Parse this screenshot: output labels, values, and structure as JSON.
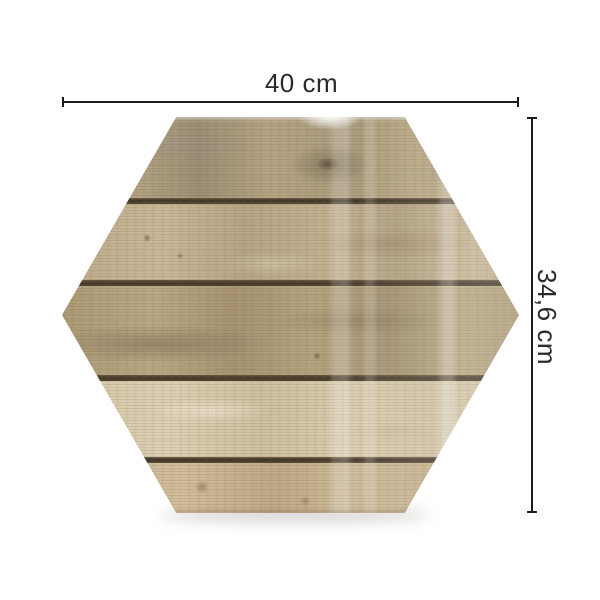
{
  "page": {
    "background": "#ffffff"
  },
  "panel": {
    "shape": "hexagon",
    "plank_count": 5,
    "wood_palette": [
      "#aa9b7b",
      "#baa989",
      "#ab9875",
      "#d6c9ab",
      "#c9b390"
    ],
    "seam_color": "#3f3426"
  },
  "dimensions": {
    "width_label": "40 cm",
    "height_label": "34,6 cm",
    "line_color": "#1b1b1b",
    "label_color": "#2a2a2a"
  }
}
